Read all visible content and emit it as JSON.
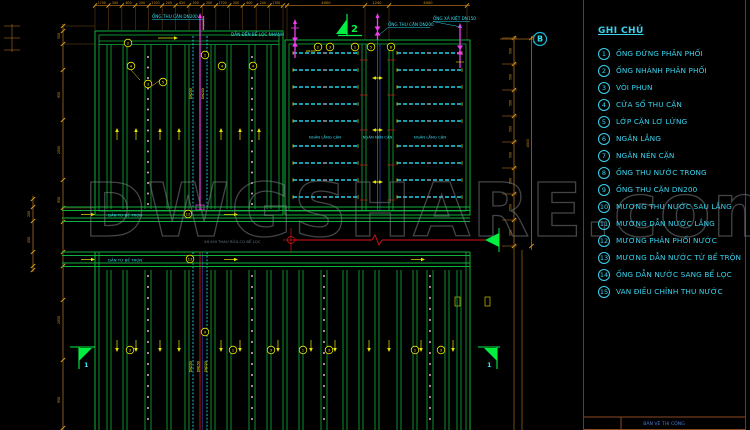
{
  "watermark": "DWGSHARE.com",
  "legend": {
    "title": "GHI CHÚ",
    "items": [
      {
        "num": "1",
        "label": "ỐNG ĐỨNG PHÂN PHỐI"
      },
      {
        "num": "2",
        "label": "ỐNG NHÁNH PHÂN PHỐI"
      },
      {
        "num": "3",
        "label": "VÒI PHUN"
      },
      {
        "num": "4",
        "label": "CỬA SỔ THU CẶN"
      },
      {
        "num": "5",
        "label": "LỚP CẶN LƠ LỬNG"
      },
      {
        "num": "6",
        "label": "NGĂN LẮNG"
      },
      {
        "num": "7",
        "label": "NGĂN NÉN CẶN"
      },
      {
        "num": "8",
        "label": "ỐNG THU NƯỚC TRONG"
      },
      {
        "num": "9",
        "label": "ỐNG THU CẶN DN200"
      },
      {
        "num": "10",
        "label": "MƯƠNG THU NƯỚC SAU LẮNG"
      },
      {
        "num": "11",
        "label": "MƯƠNG DẪN NƯỚC LẮNG"
      },
      {
        "num": "12",
        "label": "MƯƠNG PHÂN PHỐI NƯỚC"
      },
      {
        "num": "13",
        "label": "MƯƠNG DẪN NƯỚC TỪ BỂ TRỘN"
      },
      {
        "num": "14",
        "label": "ỐNG DẪN NƯỚC SANG BỂ LỌC"
      },
      {
        "num": "15",
        "label": "VAN ĐIỀU CHỈNH THU NƯỚC"
      }
    ]
  },
  "labels": {
    "pipe_top_left": "ỐNG THU CẶN DN200",
    "pipe_center": "ỐNG THU CẶN DN200",
    "pipe_drain": "ỐNG XẢ KIỆT DN150",
    "to_filter": "DẪN ĐẾN BỂ LỌC NHANH",
    "channel_upper": "DẪN TỪ BỂ TRỘN",
    "channel_lower": "DẪN TỪ BỂ TRỘN",
    "zone_left": "NGĂN LẮNG CẶN",
    "zone_center": "NGĂN NÉN CẶN",
    "zone_right": "NGĂN LẮNG CẶN",
    "wash_note": "XẢ KHI THAU RỬA CỌ BỂ LỌC",
    "dn200": "DN200",
    "dn150": "DN150"
  },
  "markers": {
    "grid_b": "B",
    "section_top": "2",
    "section_left": "1",
    "section_right": "1"
  },
  "dims": {
    "top_left": [
      "1700",
      "200",
      "600",
      "200",
      "1700",
      "200",
      "620",
      "500",
      "200",
      "1700",
      "200",
      "600",
      "200",
      "1700"
    ],
    "top_right": [
      "4000",
      "1240",
      "4000"
    ],
    "left": [
      {
        "v": "550",
        "y": 36
      },
      {
        "v": "950",
        "y": 95
      },
      {
        "v": "2050",
        "y": 150
      },
      {
        "v": "950",
        "y": 200
      },
      {
        "v": "2050",
        "y": 320
      },
      {
        "v": "950",
        "y": 400
      }
    ],
    "left_inner": [
      {
        "v": "200",
        "y": 214
      },
      {
        "v": "450",
        "y": 240
      }
    ],
    "right_segments": [
      "500",
      "500",
      "500",
      "500",
      "500",
      "500",
      "500",
      "500"
    ],
    "right_overall": "4500"
  },
  "callouts": [
    {
      "x": 128,
      "y": 43,
      "n": "2"
    },
    {
      "x": 205,
      "y": 55,
      "n": "1"
    },
    {
      "x": 131,
      "y": 66,
      "n": "4"
    },
    {
      "x": 148,
      "y": 84,
      "n": "3"
    },
    {
      "x": 163,
      "y": 82,
      "n": "5"
    },
    {
      "x": 222,
      "y": 66,
      "n": "4"
    },
    {
      "x": 253,
      "y": 66,
      "n": "4"
    },
    {
      "x": 318,
      "y": 47,
      "n": "2"
    },
    {
      "x": 330,
      "y": 47,
      "n": "3"
    },
    {
      "x": 355,
      "y": 47,
      "n": "1"
    },
    {
      "x": 371,
      "y": 47,
      "n": "5"
    },
    {
      "x": 391,
      "y": 47,
      "n": "8"
    },
    {
      "x": 188,
      "y": 214,
      "n": "12"
    },
    {
      "x": 190,
      "y": 259,
      "n": "13"
    },
    {
      "x": 130,
      "y": 350,
      "n": "3"
    },
    {
      "x": 205,
      "y": 332,
      "n": "9"
    },
    {
      "x": 233,
      "y": 350,
      "n": "1"
    },
    {
      "x": 271,
      "y": 350,
      "n": "3"
    },
    {
      "x": 303,
      "y": 350,
      "n": "1"
    },
    {
      "x": 329,
      "y": 350,
      "n": "3"
    },
    {
      "x": 415,
      "y": 350,
      "n": "1"
    },
    {
      "x": 441,
      "y": 350,
      "n": "3"
    }
  ],
  "title_block": {
    "text": "BẢN VẼ THI CÔNG"
  }
}
